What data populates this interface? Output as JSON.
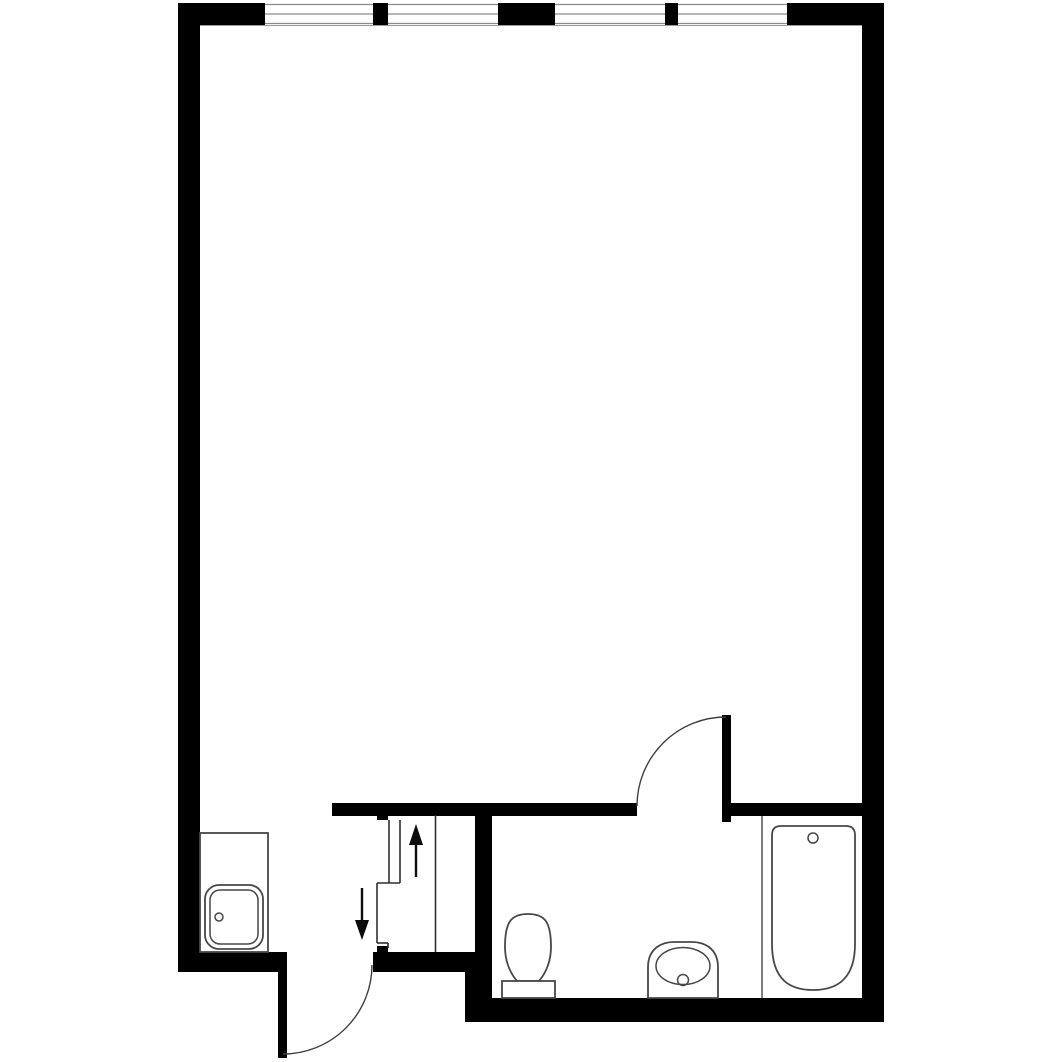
{
  "canvas": {
    "viewBox": "0 0 1062 1062",
    "width": 1062,
    "height": 1062
  },
  "colors": {
    "wall": "#000000",
    "bg": "#ffffff",
    "fixture": "#474747",
    "glass": "#8a8a8a",
    "sill": "#9a9a9a",
    "swing": "#3f3f3f",
    "stair": "#2e2e2e",
    "arrow": "#0c0c0c",
    "partition": "#3a3a3a"
  },
  "layers": [
    {
      "name": "walls",
      "class": "wall",
      "shapes": [
        {
          "type": "rect",
          "name": "top-wall-left-segment",
          "attrs": {
            "x": 178,
            "y": 3,
            "width": 87,
            "height": 22
          }
        },
        {
          "type": "rect",
          "name": "window-mullion-1",
          "attrs": {
            "x": 373,
            "y": 3,
            "width": 15,
            "height": 22
          }
        },
        {
          "type": "rect",
          "name": "window-center-pier",
          "attrs": {
            "x": 498,
            "y": 3,
            "width": 57,
            "height": 22
          }
        },
        {
          "type": "rect",
          "name": "window-mullion-2",
          "attrs": {
            "x": 665,
            "y": 3,
            "width": 13,
            "height": 22
          }
        },
        {
          "type": "rect",
          "name": "top-wall-right-segment",
          "attrs": {
            "x": 787,
            "y": 3,
            "width": 97,
            "height": 22
          }
        },
        {
          "type": "rect",
          "name": "left-exterior-wall",
          "attrs": {
            "x": 178,
            "y": 3,
            "width": 22,
            "height": 969
          }
        },
        {
          "type": "rect",
          "name": "right-exterior-wall",
          "attrs": {
            "x": 862,
            "y": 3,
            "width": 22,
            "height": 1019
          }
        },
        {
          "type": "rect",
          "name": "hall-top-wall",
          "attrs": {
            "x": 332,
            "y": 803,
            "width": 305,
            "height": 13
          }
        },
        {
          "type": "rect",
          "name": "bathroom-top-wall",
          "attrs": {
            "x": 728,
            "y": 803,
            "width": 134,
            "height": 13
          }
        },
        {
          "type": "rect",
          "name": "bathroom-left-wall",
          "attrs": {
            "x": 475,
            "y": 803,
            "width": 17,
            "height": 219
          }
        },
        {
          "type": "rect",
          "name": "stair-bottom-wall",
          "attrs": {
            "x": 373,
            "y": 952,
            "width": 119,
            "height": 20
          }
        },
        {
          "type": "rect",
          "name": "entry-side-wall",
          "attrs": {
            "x": 178,
            "y": 952,
            "width": 100,
            "height": 20
          }
        },
        {
          "type": "rect",
          "name": "bathroom-bottom-wall",
          "attrs": {
            "x": 465,
            "y": 998,
            "width": 419,
            "height": 24
          }
        },
        {
          "type": "rect",
          "name": "bathroom-corner-step",
          "attrs": {
            "x": 465,
            "y": 972,
            "width": 27,
            "height": 26
          }
        },
        {
          "type": "rect",
          "name": "stair-top-tab",
          "attrs": {
            "x": 377,
            "y": 813,
            "width": 11,
            "height": 7
          }
        },
        {
          "type": "rect",
          "name": "stair-bottom-tab",
          "attrs": {
            "x": 377,
            "y": 946,
            "width": 11,
            "height": 6
          }
        }
      ]
    },
    {
      "name": "windows",
      "class": "pane",
      "shapes": [
        {
          "type": "rect",
          "name": "window-1-pane",
          "attrs": {
            "x": 265,
            "y": 3,
            "width": 108,
            "height": 22
          }
        },
        {
          "type": "line",
          "name": "window-1-glass-outer",
          "class": "glass",
          "attrs": {
            "x1": 265,
            "y1": 4.5,
            "x2": 373,
            "y2": 4.5
          }
        },
        {
          "type": "line",
          "name": "window-1-glass-middle",
          "class": "glass",
          "attrs": {
            "x1": 265,
            "y1": 14,
            "x2": 373,
            "y2": 14
          }
        },
        {
          "type": "line",
          "name": "window-1-glass-inner",
          "class": "glass",
          "attrs": {
            "x1": 265,
            "y1": 23.5,
            "x2": 373,
            "y2": 23.5
          }
        },
        {
          "type": "rect",
          "name": "window-2-pane",
          "attrs": {
            "x": 388,
            "y": 3,
            "width": 110,
            "height": 22
          }
        },
        {
          "type": "line",
          "name": "window-2-glass-outer",
          "class": "glass",
          "attrs": {
            "x1": 388,
            "y1": 4.5,
            "x2": 498,
            "y2": 4.5
          }
        },
        {
          "type": "line",
          "name": "window-2-glass-middle",
          "class": "glass",
          "attrs": {
            "x1": 388,
            "y1": 14,
            "x2": 498,
            "y2": 14
          }
        },
        {
          "type": "line",
          "name": "window-2-glass-inner",
          "class": "glass",
          "attrs": {
            "x1": 388,
            "y1": 23.5,
            "x2": 498,
            "y2": 23.5
          }
        },
        {
          "type": "rect",
          "name": "window-3-pane",
          "attrs": {
            "x": 555,
            "y": 3,
            "width": 110,
            "height": 22
          }
        },
        {
          "type": "line",
          "name": "window-3-glass-outer",
          "class": "glass",
          "attrs": {
            "x1": 555,
            "y1": 4.5,
            "x2": 665,
            "y2": 4.5
          }
        },
        {
          "type": "line",
          "name": "window-3-glass-middle",
          "class": "glass",
          "attrs": {
            "x1": 555,
            "y1": 14,
            "x2": 665,
            "y2": 14
          }
        },
        {
          "type": "line",
          "name": "window-3-glass-inner",
          "class": "glass",
          "attrs": {
            "x1": 555,
            "y1": 23.5,
            "x2": 665,
            "y2": 23.5
          }
        },
        {
          "type": "rect",
          "name": "window-4-pane",
          "attrs": {
            "x": 678,
            "y": 3,
            "width": 109,
            "height": 22
          }
        },
        {
          "type": "line",
          "name": "window-4-glass-outer",
          "class": "glass",
          "attrs": {
            "x1": 678,
            "y1": 4.5,
            "x2": 787,
            "y2": 4.5
          }
        },
        {
          "type": "line",
          "name": "window-4-glass-middle",
          "class": "glass",
          "attrs": {
            "x1": 678,
            "y1": 14,
            "x2": 787,
            "y2": 14
          }
        },
        {
          "type": "line",
          "name": "window-4-glass-inner",
          "class": "glass",
          "attrs": {
            "x1": 678,
            "y1": 23.5,
            "x2": 787,
            "y2": 23.5
          }
        },
        {
          "type": "line",
          "name": "top-wall-inner-face-line",
          "class": "sill",
          "attrs": {
            "x1": 200,
            "y1": 25.5,
            "x2": 862,
            "y2": 25.5
          }
        }
      ]
    },
    {
      "name": "doors",
      "class": "leaf",
      "shapes": [
        {
          "type": "rect",
          "name": "entry-door-leaf",
          "attrs": {
            "x": 278,
            "y": 952,
            "width": 9,
            "height": 106
          }
        },
        {
          "type": "path",
          "name": "entry-door-swing-arc",
          "class": "swing",
          "attrs": {
            "d": "M 372 965 A 89 89 0 0 1 283 1054"
          }
        },
        {
          "type": "rect",
          "name": "bathroom-door-leaf",
          "attrs": {
            "x": 722,
            "y": 715,
            "width": 9,
            "height": 107
          }
        },
        {
          "type": "path",
          "name": "bathroom-door-swing-arc",
          "class": "swing",
          "attrs": {
            "d": "M 726 717 A 89 89 0 0 0 637 806"
          }
        }
      ]
    },
    {
      "name": "stairs",
      "class": "stairline",
      "shapes": [
        {
          "type": "line",
          "name": "stair-edge-line",
          "attrs": {
            "x1": 435.5,
            "y1": 815,
            "x2": 435.5,
            "y2": 952
          }
        },
        {
          "type": "line",
          "name": "stair-rail-outer-line",
          "attrs": {
            "x1": 389,
            "y1": 820,
            "x2": 389,
            "y2": 883
          }
        },
        {
          "type": "line",
          "name": "stair-rail-inner-line",
          "attrs": {
            "x1": 400,
            "y1": 820,
            "x2": 400,
            "y2": 883
          }
        },
        {
          "type": "line",
          "name": "stair-break-upper",
          "attrs": {
            "x1": 377,
            "y1": 883,
            "x2": 400,
            "y2": 883
          }
        },
        {
          "type": "line",
          "name": "stair-break-vertical",
          "attrs": {
            "x1": 377,
            "y1": 883,
            "x2": 377,
            "y2": 943
          }
        },
        {
          "type": "line",
          "name": "stair-break-lower",
          "attrs": {
            "x1": 377,
            "y1": 943,
            "x2": 388,
            "y2": 943
          }
        },
        {
          "type": "line",
          "name": "stair-break-foot",
          "attrs": {
            "x1": 388,
            "y1": 943,
            "x2": 388,
            "y2": 948
          }
        },
        {
          "type": "line",
          "name": "stair-up-arrow-shaft",
          "class": "arrowshaft",
          "attrs": {
            "x1": 416,
            "y1": 843,
            "x2": 416,
            "y2": 877
          }
        },
        {
          "type": "polygon",
          "name": "stair-up-arrow-head",
          "class": "arrowhead",
          "attrs": {
            "points": "416,824 409,845 423,845"
          }
        },
        {
          "type": "line",
          "name": "entry-down-arrow-shaft",
          "class": "arrowshaft",
          "attrs": {
            "x1": 362,
            "y1": 888,
            "x2": 362,
            "y2": 921
          }
        },
        {
          "type": "polygon",
          "name": "entry-down-arrow-head",
          "class": "arrowhead",
          "attrs": {
            "points": "362,940 355,920 369,920"
          }
        }
      ]
    },
    {
      "name": "fixtures",
      "class": "fixture",
      "shapes": [
        {
          "type": "rect",
          "name": "kitchen-counter",
          "attrs": {
            "x": 200,
            "y": 833,
            "width": 68,
            "height": 119
          }
        },
        {
          "type": "rect",
          "name": "kitchen-sink-outer",
          "attrs": {
            "x": 205,
            "y": 885,
            "width": 58,
            "height": 64,
            "rx": 14
          }
        },
        {
          "type": "rect",
          "name": "kitchen-sink-inner",
          "class": "fixture-fine",
          "attrs": {
            "x": 210,
            "y": 890,
            "width": 48,
            "height": 54,
            "rx": 10
          }
        },
        {
          "type": "circle",
          "name": "kitchen-sink-faucet",
          "class": "fixture-fine",
          "attrs": {
            "cx": 219,
            "cy": 917,
            "r": 4
          }
        },
        {
          "type": "path",
          "name": "toilet-bowl",
          "attrs": {
            "d": "M 505 947 C 505 922 511 914 528 914 C 545 914 551 922 551 947 C 551 961 546 973 539 981 L 517 981 C 510 973 505 961 505 947 Z"
          }
        },
        {
          "type": "rect",
          "name": "toilet-tank",
          "attrs": {
            "x": 502,
            "y": 981,
            "width": 53,
            "height": 17
          }
        },
        {
          "type": "path",
          "name": "bathroom-sink-vanity",
          "attrs": {
            "d": "M 648 998 L 648 967 Q 648 954 657 947 Q 664 942 674 942 L 692 942 Q 702 942 709 947 Q 718 954 718 967 L 718 998 Z"
          }
        },
        {
          "type": "ellipse",
          "name": "bathroom-sink-basin",
          "class": "fixture-fine",
          "attrs": {
            "cx": 683,
            "cy": 966,
            "rx": 27,
            "ry": 18.5
          }
        },
        {
          "type": "circle",
          "name": "bathroom-sink-drain",
          "class": "fixture-fine",
          "attrs": {
            "cx": 683,
            "cy": 980,
            "r": 5.5
          }
        },
        {
          "type": "line",
          "name": "tub-alcove-partition",
          "class": "partition",
          "attrs": {
            "x1": 762,
            "y1": 816,
            "x2": 762,
            "y2": 998
          }
        },
        {
          "type": "path",
          "name": "bathtub",
          "attrs": {
            "d": "M 772 835 Q 772 826 781 826 L 846 826 Q 855 826 855 835 L 855 944 C 855 981 835 990 813 990 C 791 990 772 981 772 944 Z"
          }
        },
        {
          "type": "circle",
          "name": "bathtub-drain",
          "class": "fixture-fine",
          "attrs": {
            "cx": 813,
            "cy": 838,
            "r": 5
          }
        }
      ]
    }
  ]
}
